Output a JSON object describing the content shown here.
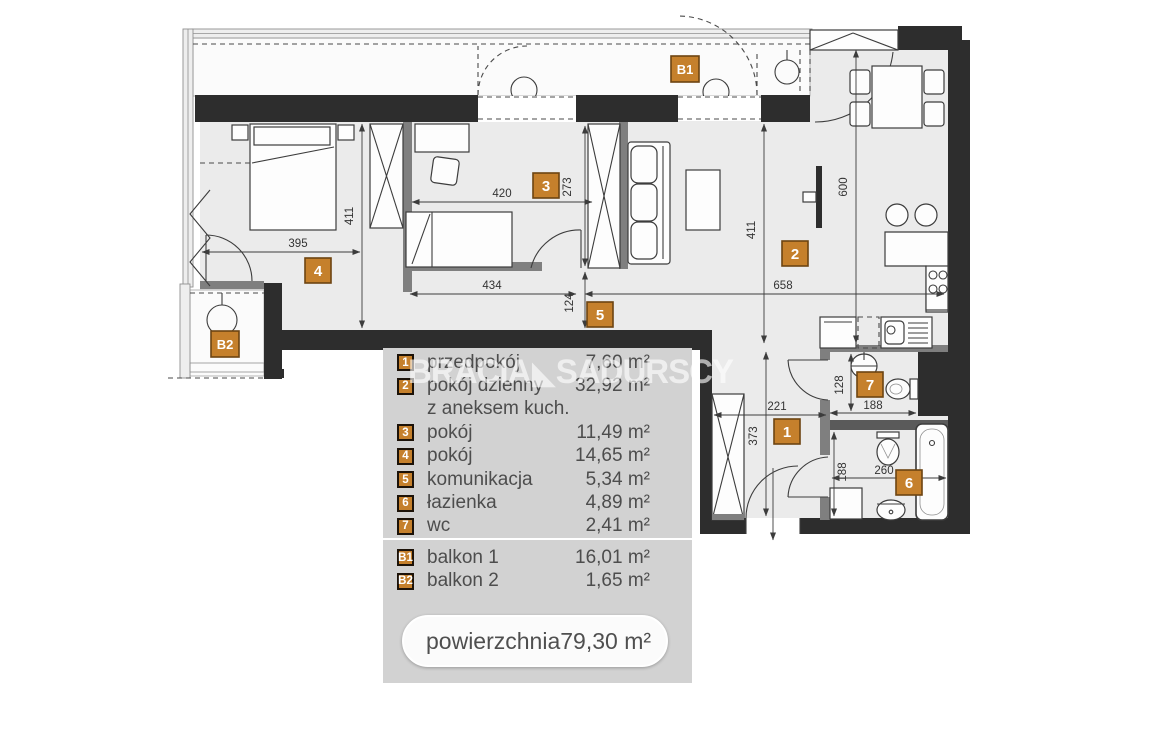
{
  "watermark": {
    "part1": "BRACIA",
    "logo": "◣",
    "part2": "SADURSCY"
  },
  "plan": {
    "dims": {
      "room3_width": "420",
      "room3_depth": "273",
      "room4_width": "395",
      "room4_depth": "411",
      "living_depth": "411",
      "living_width": "658",
      "kitchen_depth": "600",
      "corridor_width": "434",
      "corridor_depth": "124",
      "hall_width": "221",
      "hall_depth": "373",
      "wc_depth": "128",
      "wc_width": "188",
      "bath_depth": "188",
      "bath_width": "260"
    }
  },
  "legend": {
    "rooms": [
      {
        "id": "1",
        "label": "przedpokój",
        "area": "7,60 m²"
      },
      {
        "id": "2",
        "label": "pokój dzienny",
        "label2": "z aneksem kuch.",
        "area": "32,92 m²"
      },
      {
        "id": "3",
        "label": "pokój",
        "area": "11,49 m²"
      },
      {
        "id": "4",
        "label": "pokój",
        "area": "14,65 m²"
      },
      {
        "id": "5",
        "label": "komunikacja",
        "area": "5,34 m²"
      },
      {
        "id": "6",
        "label": "łazienka",
        "area": "4,89 m²"
      },
      {
        "id": "7",
        "label": "wc",
        "area": "2,41 m²"
      }
    ],
    "balconies": [
      {
        "id": "B1",
        "label": "balkon 1",
        "area": "16,01 m²"
      },
      {
        "id": "B2",
        "label": "balkon 2",
        "area": "1,65 m²"
      }
    ],
    "total": {
      "label": "powierzchnia",
      "area": "79,30 m²"
    }
  },
  "colors": {
    "badge": "#c5802c",
    "wall": "#2d2d2d",
    "legend_bg": "#d2d2d2"
  }
}
